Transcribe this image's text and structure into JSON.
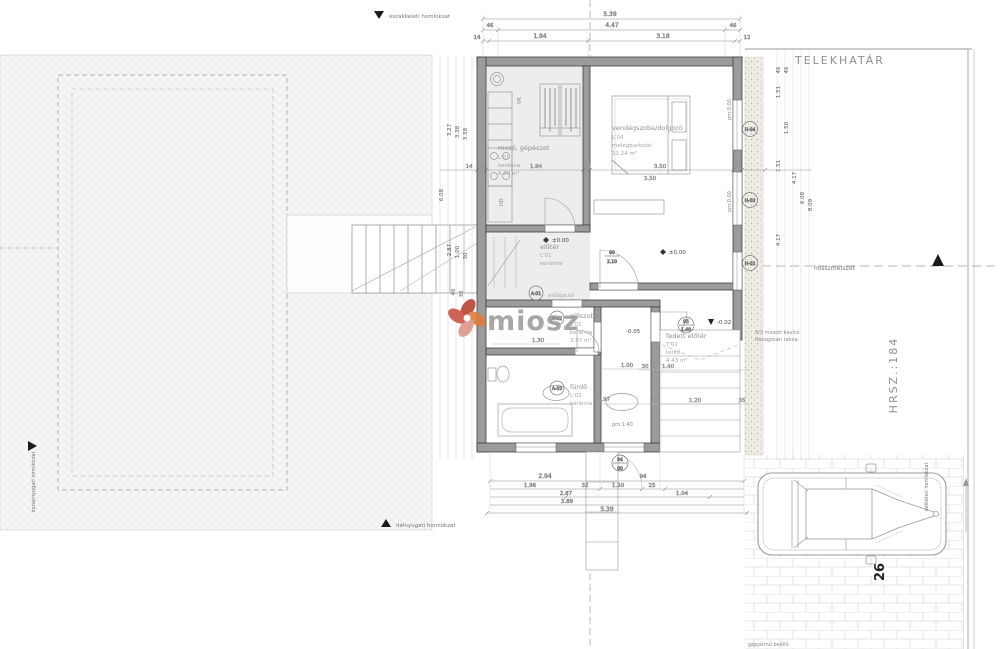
{
  "site": {
    "property_line": "TELEKHATÁR",
    "plot_number": "HRSZ.:184",
    "section_label": "hosszmetszet",
    "parking_label": "gépjármű beálló",
    "parking_number": "26",
    "gravel_note_1": "5/3 mosott kavics",
    "gravel_note_2": "hézagosan rakva",
    "facades": {
      "ne": "északkeleti homlokzat",
      "sw": "délnyugati homlokzat",
      "nw": "északnyugati homlokzat",
      "se": "délkeleti homlokzat"
    }
  },
  "watermark": {
    "text": "miosz",
    "logo_red": "#b73e2e",
    "logo_orange": "#e07b39",
    "logo_pink": "#dd9486"
  },
  "rooms": {
    "laundry": {
      "name": "mosó, gépészet",
      "code": "L'01",
      "material": "kerámia",
      "area": "6.60 m²"
    },
    "guest": {
      "name": "vendégszoba/dolgozó",
      "code": "L'04",
      "material": "melegburkolat",
      "area": "11.24 m²"
    },
    "hall": {
      "name": "előtér",
      "code": "L'01",
      "material": "kerámia"
    },
    "entry": {
      "name": "előszoba",
      "code": "L'01",
      "material": "kerámia",
      "area": "3.97 m²"
    },
    "bath": {
      "name": "fürdő",
      "code": "L'02",
      "material": "kerámia"
    },
    "porch": {
      "name": "fedett előtér",
      "code": "T'01",
      "material": "térkő",
      "area": "4.43 m²"
    },
    "stairs": {
      "name": "előlépcső"
    }
  },
  "markers": {
    "a01": "A-01",
    "a02": "A-02",
    "a03": "A-03",
    "h02": "H-02",
    "h03": "H-03",
    "h04": "H-04",
    "vk": "VK",
    "hd": "HD"
  },
  "levels": {
    "zero": "±0.00",
    "minus02": "-0.02",
    "minus05": "-0.05",
    "pm0": "pm:0.00",
    "pm140": "pm:1.40"
  },
  "openings": {
    "door_w": "90",
    "door_h": "2.10",
    "win_w": "95",
    "win_h": "1.40",
    "win2_w": "84",
    "win2_h": "60"
  },
  "dims": {
    "top": [
      "5.39",
      "46",
      "4.47",
      "46",
      "14",
      "1.94",
      "3.18",
      "12"
    ],
    "bottom": [
      "2.94",
      "94",
      "1.96",
      "32",
      "1.50",
      "25",
      "2.87",
      "1.04",
      "3.89",
      "5.39"
    ],
    "left": [
      "6.08",
      "3.27",
      "3.38",
      "3.58",
      "2.87",
      "1.00",
      "30",
      "46",
      "30"
    ],
    "right": [
      "46",
      "46",
      "1.51",
      "1.50",
      "1.51",
      "4.17",
      "6.08",
      "4.17",
      "8.09"
    ],
    "h1": [
      "14",
      "30",
      "1.84",
      "13",
      "3.50",
      "30"
    ],
    "h2": [
      "30",
      "1.40",
      "14",
      "1.20",
      "35"
    ],
    "misc": [
      "1.30",
      "1.00",
      "2.97",
      "3.50"
    ]
  }
}
